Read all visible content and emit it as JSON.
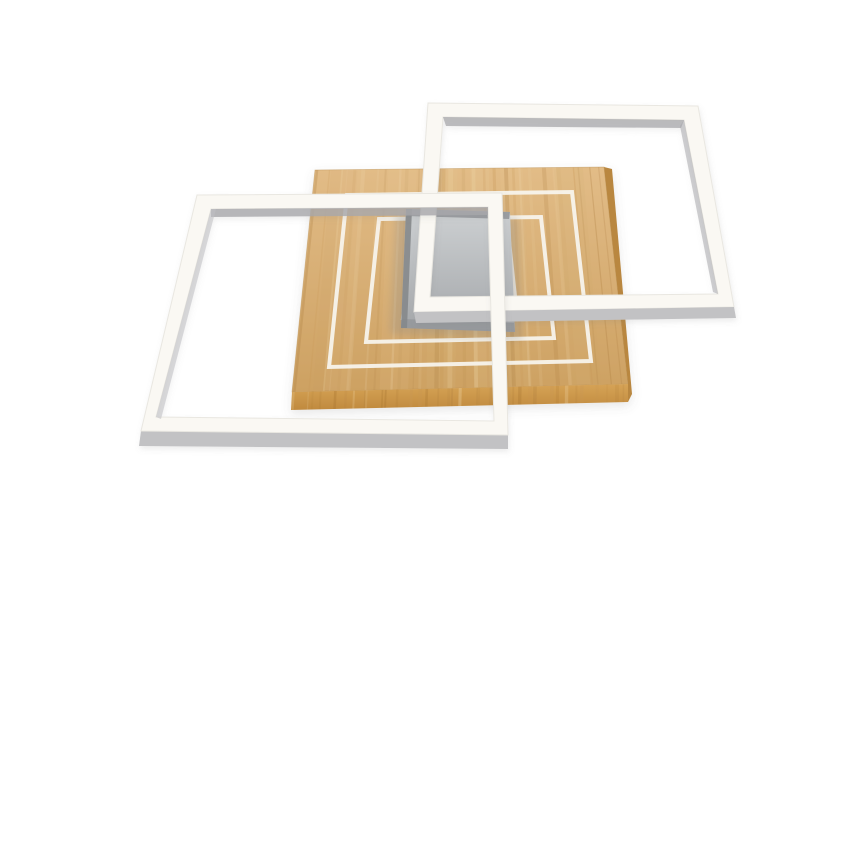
{
  "meta": {
    "description": "Product photo: modern LED ceiling lamp with light oak wooden panel, two overlapping white square LED frames and a brushed grey ceiling mount plate on a white background"
  },
  "colors": {
    "background": "#ffffff",
    "wood_top_light": "#e2bc87",
    "wood_top_dark": "#cda162",
    "wood_grain_light": "#f0d7aa",
    "wood_grain_mid": "#c89755",
    "wood_grain_dark": "#a97a3c",
    "wood_front_light": "#d6a356",
    "wood_front_dark": "#c08a3e",
    "wood_side": "#b9873f",
    "wood_edge_line": "#b98f52",
    "frame_white": "#faf8f3",
    "frame_edge": "#e9e7e1",
    "frame_depth_gray": "#c2c2c4",
    "frame_inner_shadow": "#a8a8ab",
    "groove_line": "#f7f3ec",
    "plate_top": "#cdd0d2",
    "plate_bottom": "#a4a7aa",
    "plate_edge_dark": "#85888b",
    "plate_band": "#95989b",
    "shadow": "#8a8a8a"
  }
}
